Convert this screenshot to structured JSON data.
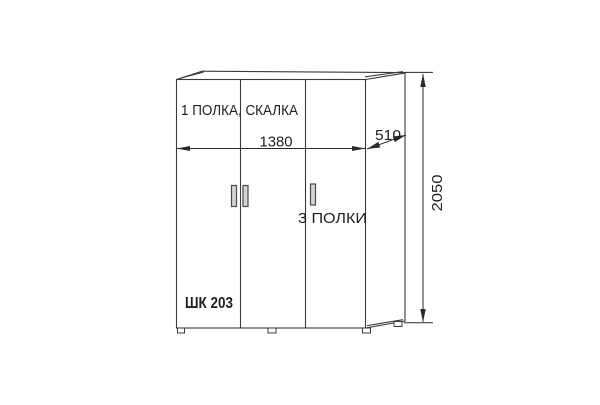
{
  "diagram": {
    "product_code": "ШК 203",
    "notes": {
      "top": "1 ПОЛКА, СКАЛКА",
      "right": "3 ПОЛКИ"
    },
    "dimensions_mm": {
      "width": "1380",
      "depth": "510",
      "height": "2050"
    },
    "colors": {
      "background": "#ffffff",
      "outline": "#3a3a3a",
      "dimension": "#2a2a2a",
      "text": "#1f1f1f",
      "handle_fill": "#d4d4d4",
      "handle_stroke": "#4a4a4a"
    }
  }
}
